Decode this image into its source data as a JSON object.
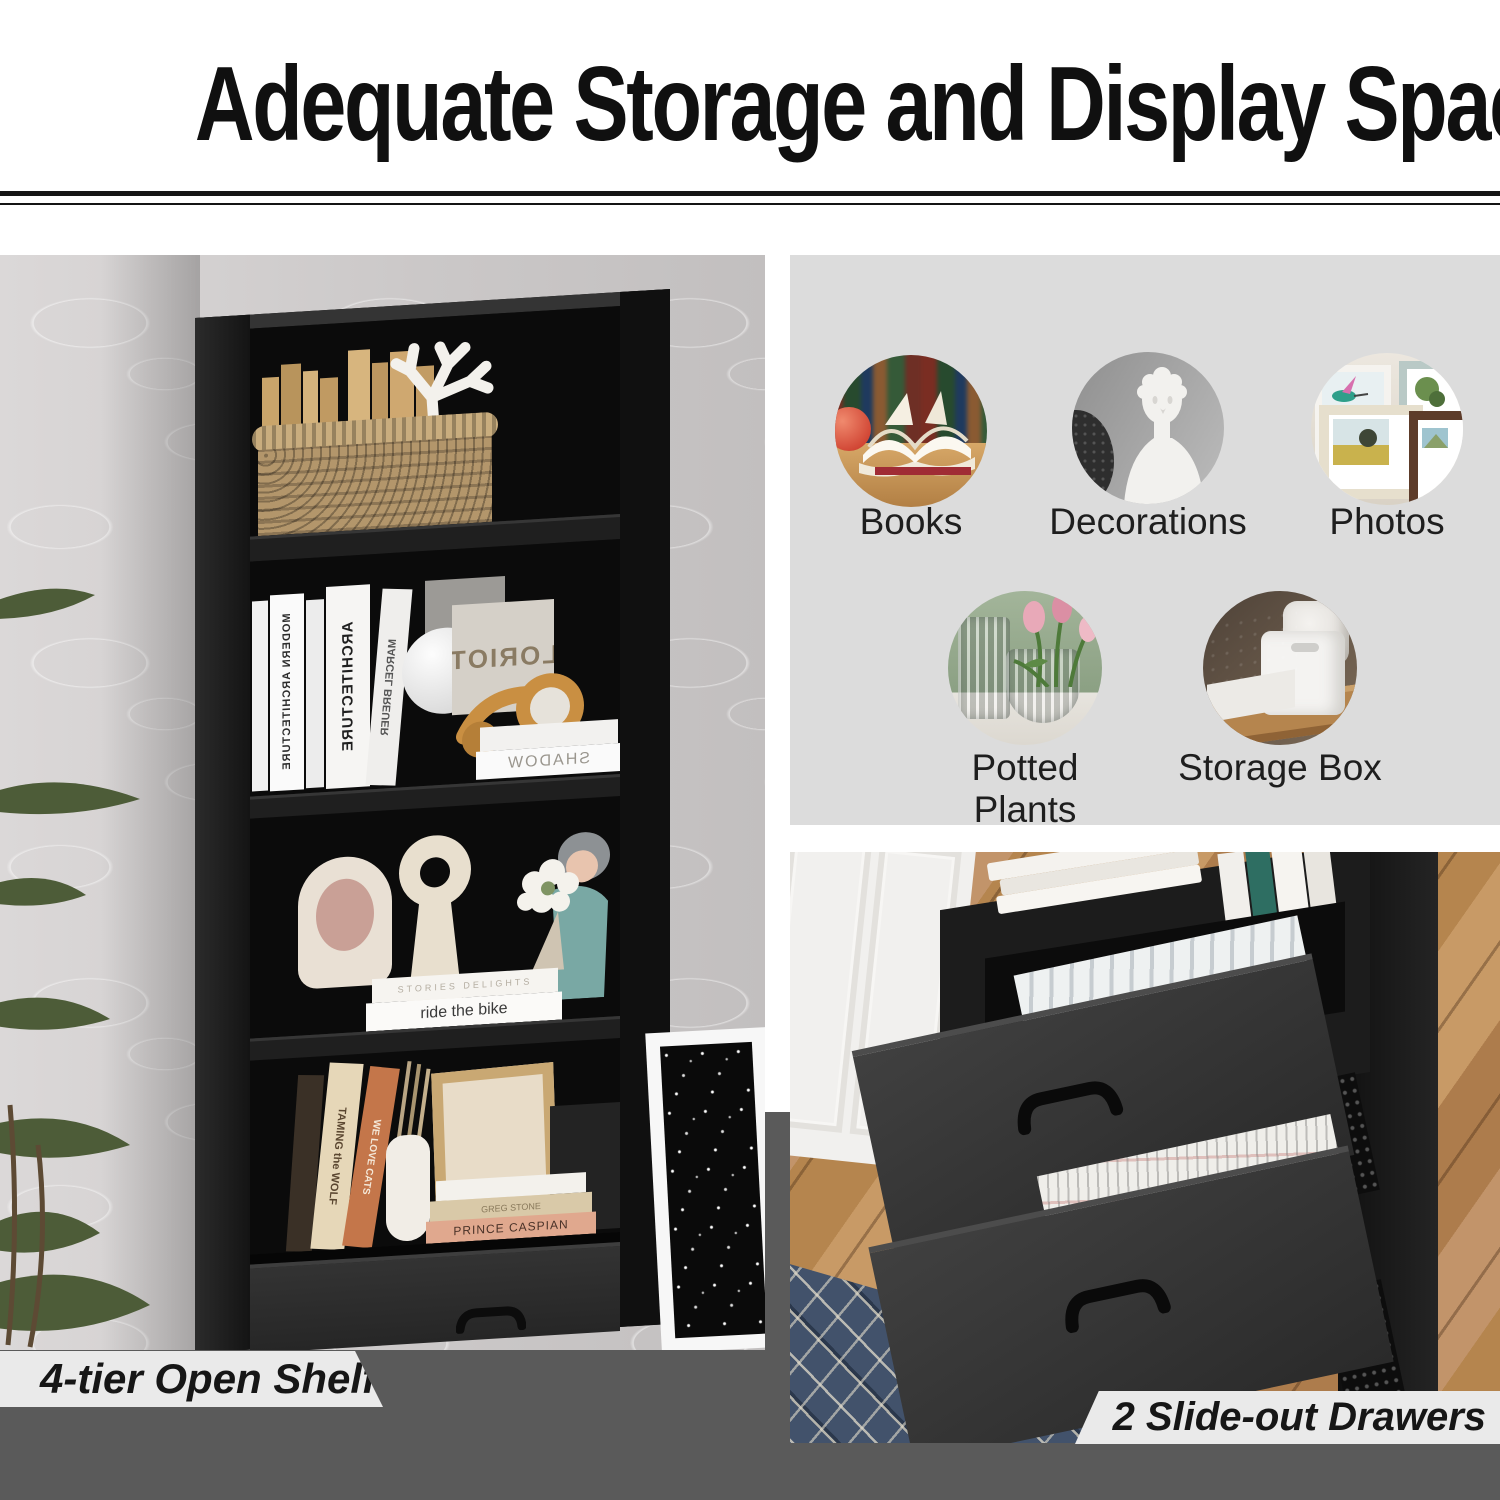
{
  "header": {
    "title": "Adequate Storage and Display Space"
  },
  "left_photo": {
    "caption": "4-tier Open Shelf",
    "spines": {
      "modern_architecture": "MODERN ARCHITECTURE",
      "architecture": "ARCHITECTURE",
      "marcel_breuer": "MARCEL BREUER",
      "loriot": "LORIOT",
      "shadow": "SHADOW",
      "stories": "STORIES DELIGHTS",
      "ride_the_bike": "ride the bike",
      "taming_the_wolf": "TAMING the WOLF",
      "greg_stone": "GREG STONE",
      "we_love_cats": "WE LOVE CATS",
      "prince_caspian": "PRINCE CASPIAN"
    }
  },
  "right_panel": {
    "items": [
      {
        "label": "Books"
      },
      {
        "label": "Decorations"
      },
      {
        "label": "Photos"
      },
      {
        "label": "Potted Plants"
      },
      {
        "label": "Storage Box"
      }
    ]
  },
  "right_photo": {
    "caption": "2 Slide-out Drawers",
    "newspaper_text": "Texas Coast Beaches"
  },
  "colors": {
    "backdrop_gray": "#5a5a5a",
    "panel_gray": "#dcdcdc",
    "banner_gray": "#eaeaea",
    "cabinet_black": "#141414",
    "title_black": "#101010"
  }
}
